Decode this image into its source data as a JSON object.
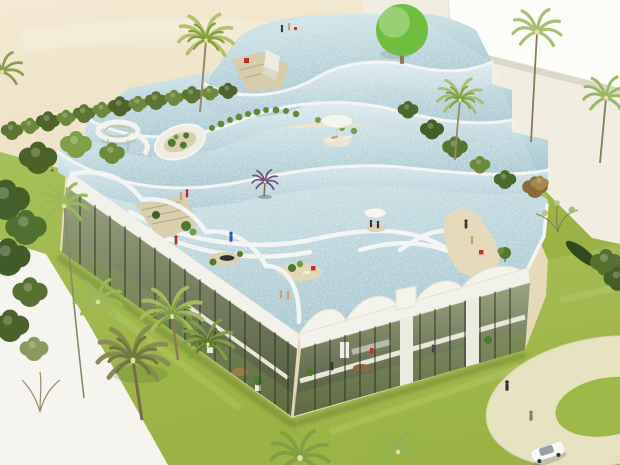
{
  "scene": {
    "type": "architectural-rendering",
    "view": "aerial-perspective",
    "subject": "Aerial rendering of a white building whose stepped roof is a cascade of terraced swimming pools, set in lawns with palm trees, a sand beach area, a paved plaza with a boundary wall, and a circular drop-off ring with a white car",
    "elements": [
      "four cascading rooftop water tiers",
      "spiral water slide",
      "oval planted courtyard",
      "rooftop sun umbrellas and loungers",
      "small planted islands in the rooftop pools",
      "rooftop sand beach deck",
      "glass curtain-wall ground floor with interior furniture and plants",
      "white fascia with scalloped vault bays",
      "surrounding lawn",
      "sand beach ground at top-left",
      "cream paved plaza at top-right",
      "white boundary wall",
      "circular paved ring drive",
      "palm trees, hedges and shrubs",
      "tiny human figures",
      "white car"
    ],
    "palette": {
      "water": "#c9dfe4",
      "water_deep": "#aac9d3",
      "rim_white": "#f2f5f3",
      "fascia": "#f3f2ea",
      "sand": "#ecdfc0",
      "pavement": "#f1eee1",
      "lawn": "#a2bc52",
      "lawn_bright": "#9cb748",
      "glass": "#5d684a",
      "mullion": "#2a3021",
      "ring_path": "#e7e2bf",
      "wall_white": "#fcfcf9",
      "tree_green": "#6fbf3f",
      "palm_green": "#7da23f",
      "accent_red": "#c43026",
      "accent_blue": "#2a52cc"
    }
  }
}
